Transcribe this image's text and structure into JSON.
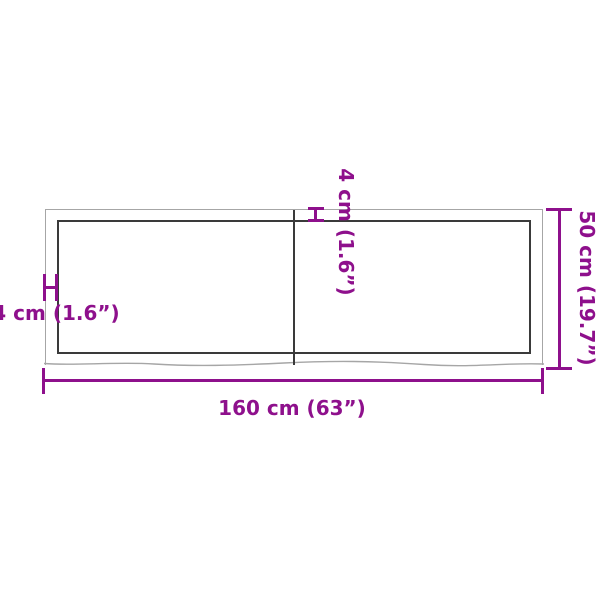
{
  "diagram": {
    "kind": "product-dimension-diagram",
    "subject": "rectangular wooden panel top view with live edge",
    "dimensions": {
      "width_label": "160 cm (63”)",
      "height_label": "50 cm (19.7”)",
      "thickness_left_label": "4 cm (1.6”)",
      "thickness_top_label": "4 cm (1.6”)"
    },
    "values": {
      "width_cm": 160,
      "width_in": 63,
      "height_cm": 50,
      "height_in": 19.7,
      "thickness_cm": 4,
      "thickness_in": 1.6
    },
    "colors": {
      "dimension_accent": "#8E108C",
      "outline_inner": "#3A3A3A",
      "outline_outer": "#A6A6A6",
      "background": "#FFFFFF"
    }
  }
}
